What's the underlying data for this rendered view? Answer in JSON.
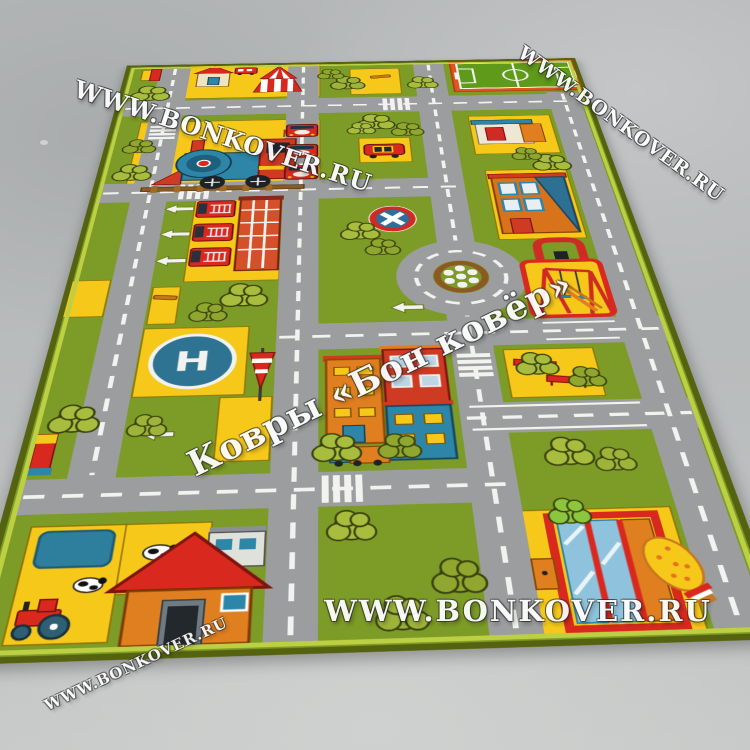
{
  "watermarks": {
    "site": "WWW.BONKOVER.RU",
    "brand": "Ковры «Бон ковёр»"
  },
  "rug": {
    "helipad_letter": "H"
  },
  "colors": {
    "floor": "#b4b7b8",
    "grass": "#7d9b27",
    "bush": "#a8bc3e",
    "road": "#9b9d9e",
    "marking": "#f2f2ee",
    "yellow": "#f5c81a",
    "red": "#d9291f",
    "orange": "#e07f1f",
    "blue": "#2d86a8",
    "teal": "#2e7391",
    "rug_border": "#bdd043",
    "watermark": "#ffffff"
  }
}
